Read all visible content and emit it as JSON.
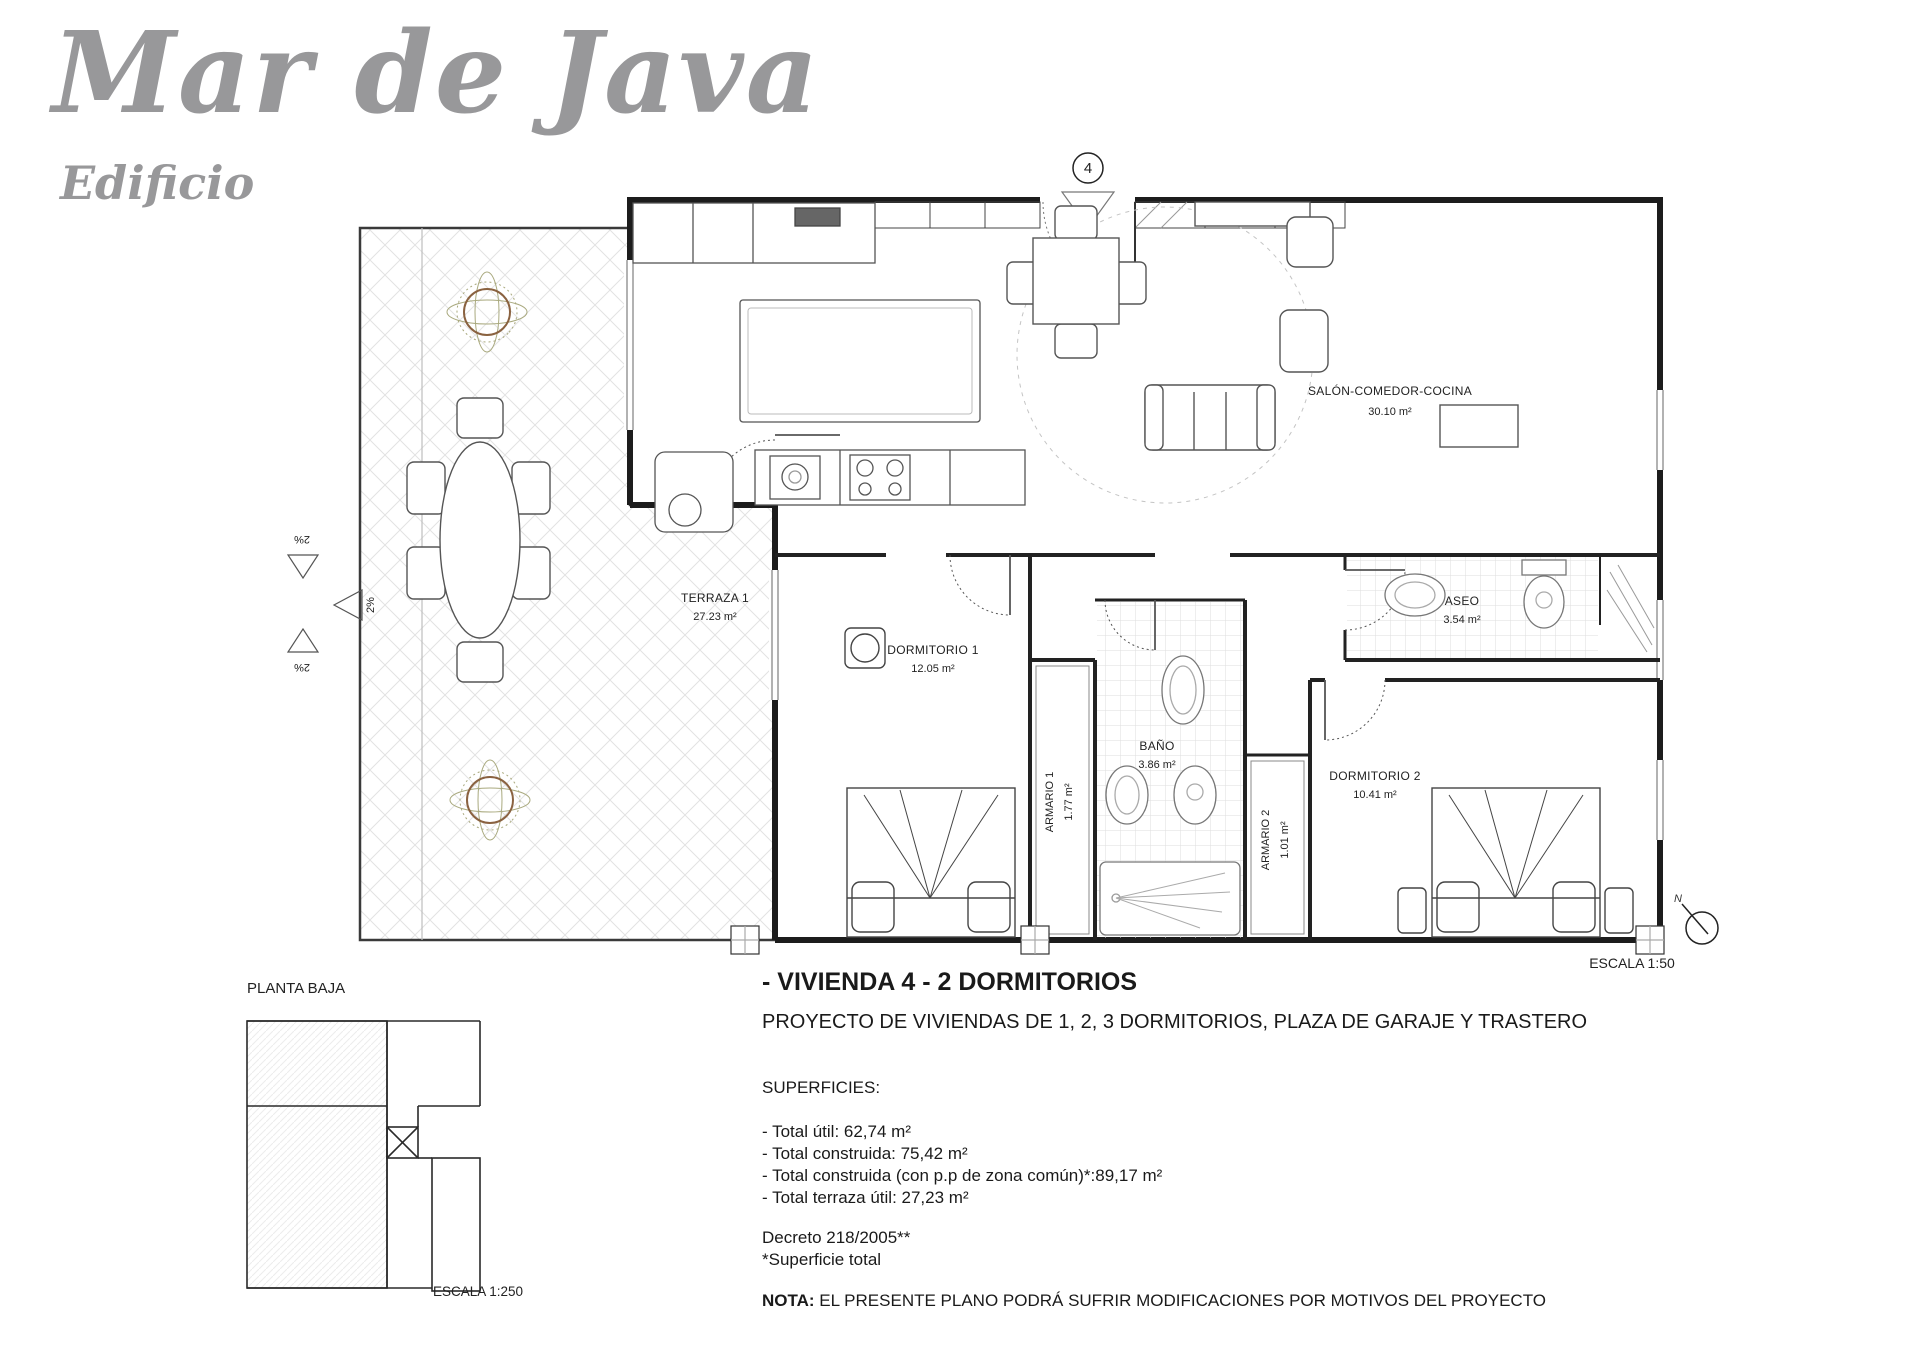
{
  "logo": {
    "title": "Mar de Java",
    "subtitle": "Edificio"
  },
  "plan": {
    "entrance_marker": "4",
    "scale_label": "ESCALA 1:50",
    "north_label": "N",
    "slope_label": "2%",
    "rooms": {
      "terraza": {
        "name": "TERRAZA 1",
        "area": "27.23 m²"
      },
      "salon": {
        "name": "SALÓN-COMEDOR-COCINA",
        "area": "30.10 m²"
      },
      "dormitorio1": {
        "name": "DORMITORIO 1",
        "area": "12.05 m²"
      },
      "armario1": {
        "name": "ARMARIO 1",
        "area": "1.77 m²"
      },
      "bano": {
        "name": "BAÑO",
        "area": "3.86 m²"
      },
      "armario2": {
        "name": "ARMARIO 2",
        "area": "1.01 m²"
      },
      "dormitorio2": {
        "name": "DORMITORIO 2",
        "area": "10.41 m²"
      },
      "aseo": {
        "name": "ASEO",
        "area": "3.54 m²"
      }
    }
  },
  "keyplan": {
    "title": "PLANTA BAJA",
    "scale_label": "ESCALA 1:250"
  },
  "info": {
    "heading": "- VIVIENDA 4 - 2 DORMITORIOS",
    "subheading": "PROYECTO DE VIVIENDAS DE 1, 2, 3 DORMITORIOS, PLAZA DE GARAJE Y TRASTERO",
    "superficies_title": "SUPERFICIES:",
    "superficies": [
      "- Total útil: 62,74 m²",
      "- Total construida: 75,42 m²",
      "- Total construida (con p.p de zona común)*:89,17 m²",
      "- Total terraza útil: 27,23 m²"
    ],
    "decreto": "Decreto 218/2005**",
    "superficie_note": "*Superficie total",
    "nota_label": "NOTA:",
    "nota_text": "EL PRESENTE PLANO PODRÁ SUFRIR MODIFICACIONES POR MOTIVOS DEL PROYECTO"
  },
  "colors": {
    "logo_gray": "#98989a",
    "wall_black": "#1c1c1c",
    "furniture_gray": "#555555",
    "hatch_gray": "#e2e2e2",
    "plant_brown": "#8a6240",
    "plant_olive": "#a9a97e"
  }
}
